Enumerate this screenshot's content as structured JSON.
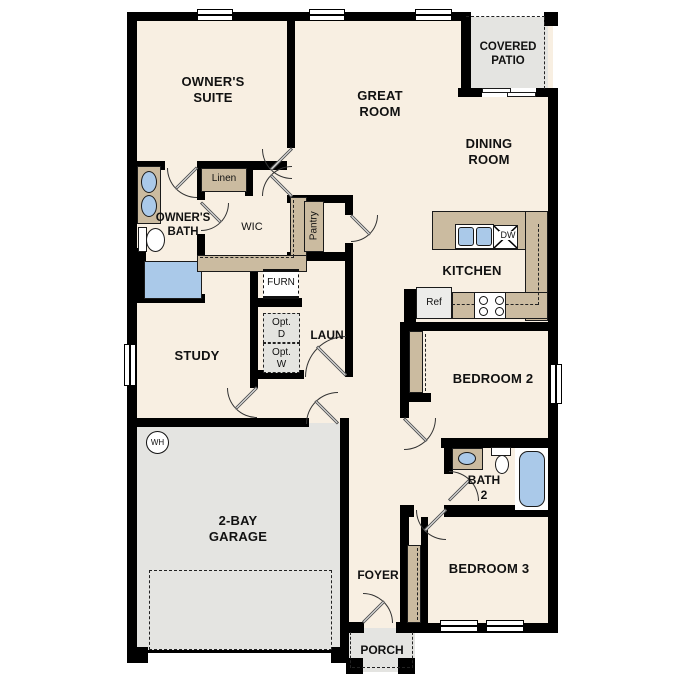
{
  "rooms": {
    "owners_suite": "OWNER'S\nSUITE",
    "great_room": "GREAT\nROOM",
    "dining_room": "DINING\nROOM",
    "covered_patio": "COVERED\nPATIO",
    "owners_bath": "OWNER'S\nBATH",
    "wic": "WIC",
    "study": "STUDY",
    "kitchen": "KITCHEN",
    "laundry": "LAUN",
    "bedroom2": "BEDROOM 2",
    "bath2": "BATH\n2",
    "bedroom3": "BEDROOM 3",
    "garage": "2-BAY\nGARAGE",
    "foyer": "FOYER",
    "porch": "PORCH"
  },
  "features": {
    "linen": "Linen",
    "pantry": "Pantry",
    "furnace": "FURN",
    "opt_dryer": "Opt.\nD",
    "opt_washer": "Opt.\nW",
    "refrigerator": "Ref",
    "dishwasher": "DW",
    "water_heater": "WH"
  },
  "colors": {
    "floor": "#f8efe2",
    "wall": "#000000",
    "counter_tan": "#cbbba0",
    "concrete_gray": "#e4e4e1",
    "fixture_blue": "#aac9e9",
    "optional_box_gray": "#e4e4e0"
  }
}
